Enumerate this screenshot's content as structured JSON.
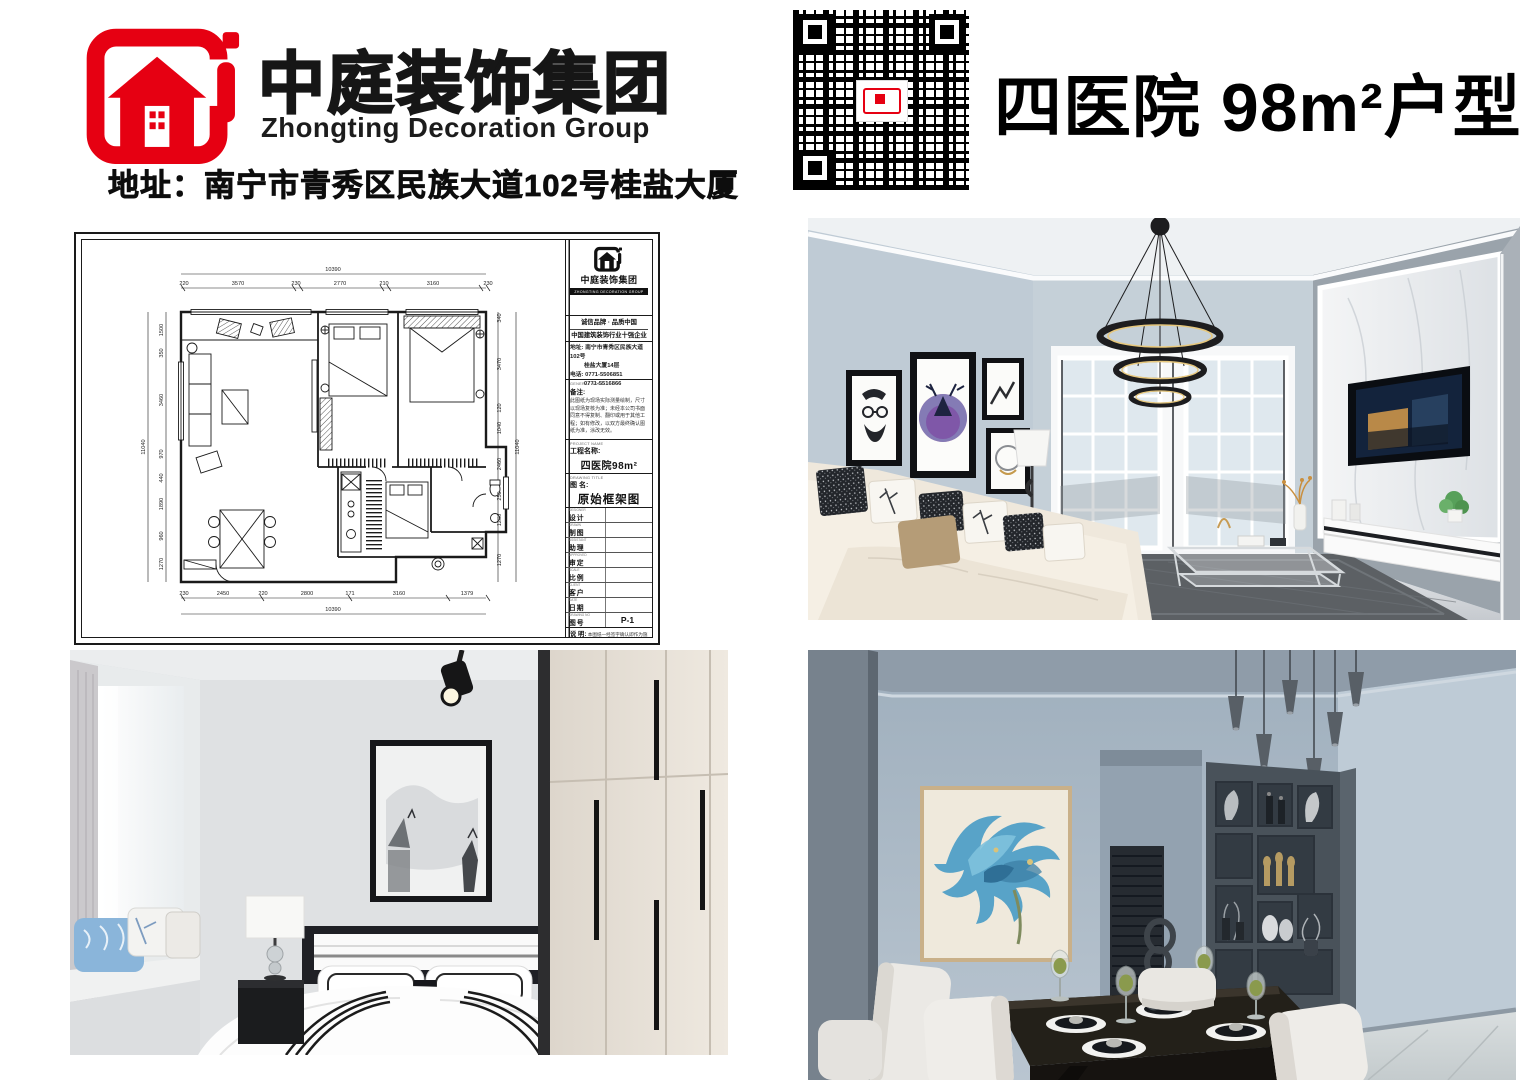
{
  "header": {
    "brand_cn": "中庭装饰集团",
    "brand_en": "Zhongting Decoration Group",
    "address": "地址：南宁市青秀区民族大道102号桂盐大厦",
    "title": "四医院 98m²户型",
    "brand_red": "#e60012"
  },
  "qr": {
    "name": "wechat-qr-code"
  },
  "plan_sheet": {
    "titleblock": {
      "logo_text": "中庭装饰集团",
      "logo_bar": "ZHONGTING DECORATION GROUP",
      "slogan1": "诚信品牌 · 品质中国",
      "slogan2": "中国建筑装饰行业十强企业",
      "addr1": "地址: 南宁市青秀区民族大道102号",
      "addr2": "桂盐大厦14层",
      "tel1": "电话: 0771-5506851",
      "tel2": "0771-5516866",
      "remark_label": "备注:",
      "remark_text": "此图纸为现场实际测量绘制，尺寸以现场复核为准；未经本公司书面同意不得复制、翻印或用于其他工程；如有修改，以双方最终确认图纸为准，涂改无效。",
      "project_caption": "PROJECT NAME",
      "project_label": "工程名称:",
      "project_value": "四医院98m²",
      "drawing_caption": "DRAWING TITLE",
      "drawing_label": "图  名:",
      "drawing_value": "原始框架图",
      "fields": [
        {
          "caption": "DESIGNER",
          "label": "设计",
          "value": ""
        },
        {
          "caption": "DRAWN",
          "label": "制图",
          "value": ""
        },
        {
          "caption": "ASSISTANT",
          "label": "助理",
          "value": ""
        },
        {
          "caption": "APPROVED",
          "label": "审定",
          "value": ""
        },
        {
          "caption": "SCALE",
          "label": "比例",
          "value": ""
        },
        {
          "caption": "CLIENT",
          "label": "客户",
          "value": ""
        },
        {
          "caption": "DATE",
          "label": "日期",
          "value": ""
        },
        {
          "caption": "DRAWING NO",
          "label": "图号",
          "value": "P-1"
        }
      ],
      "note_label": "说  明:",
      "note_text": "本图纸一经签字确认即作为施工依据；图内尺寸以现场复核为准，未经许可请勿外传。"
    },
    "dims": {
      "total_w": "10390",
      "total_h": "11040",
      "top": [
        "220",
        "3570",
        "230",
        "2770",
        "210",
        "3160",
        "230"
      ],
      "bottom": [
        "230",
        "2450",
        "220",
        "2800",
        "171",
        "3160",
        "1379"
      ],
      "left": [
        "1500",
        "350",
        "3460",
        "970",
        "440",
        "1890",
        "960",
        "1270"
      ],
      "right": [
        "340",
        "3470",
        "120",
        "1040",
        "2460",
        "250",
        "1280",
        "1270"
      ]
    }
  },
  "photos": {
    "living": {
      "name": "living-room-render",
      "wall_color": "#bfcbd5",
      "accent_wall": "#8e979e"
    },
    "bedroom": {
      "name": "bedroom-render",
      "wall_color": "#d9dcdf"
    },
    "dining": {
      "name": "dining-room-render",
      "wall_color": "#b3c0cc"
    }
  }
}
